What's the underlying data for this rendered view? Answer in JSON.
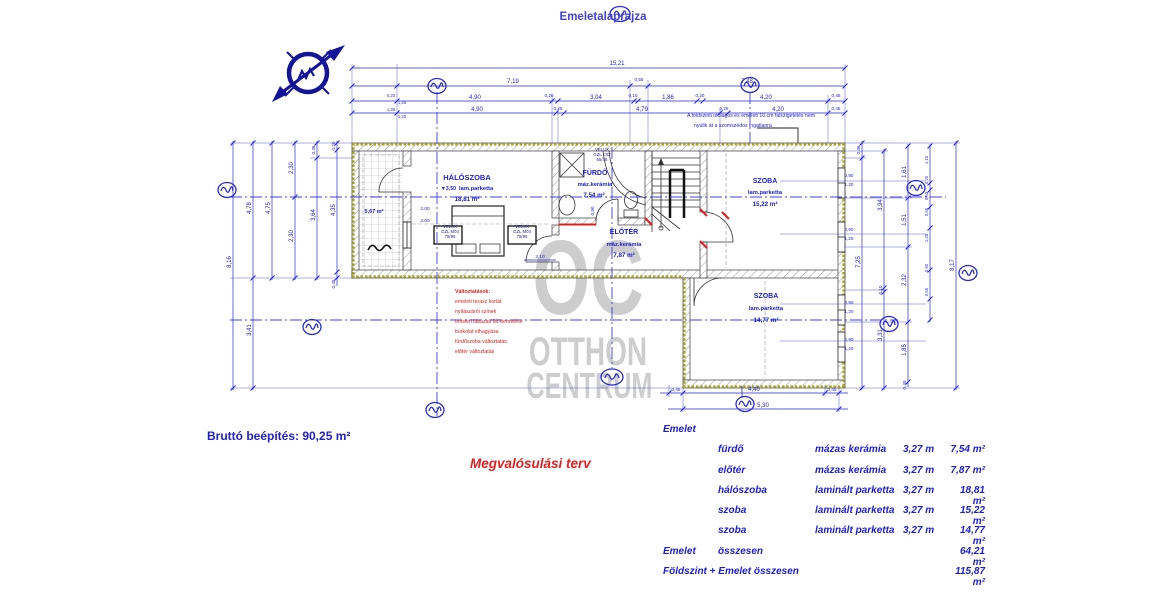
{
  "title": "Emeletalaprajza",
  "watermark": {
    "line1": "OC",
    "line2": "OTTHON",
    "line3": "CENTRUM"
  },
  "plan": {
    "note_line1": "A földszinti utólagos és emeleti 10 cm falszigetelés nem",
    "note_line2": "nyúlik át a szomszédos ingatlanra",
    "rooms": [
      {
        "name": "HÁLÓSZOBA",
        "elev": "▼3,50",
        "finish": "lam.parketta",
        "area": "18,81 m²"
      },
      {
        "name": "FÜRDŐ",
        "finish": "máz.kerámia",
        "area": "7,54 m²"
      },
      {
        "name": "ELŐTÉR",
        "finish": "máz.kerámia",
        "area": "7,87 m²"
      },
      {
        "name": "SZOBA",
        "finish": "lam.parketta",
        "area": "15,22 m²"
      },
      {
        "name": "SZOBA",
        "finish": "lam.parketta",
        "area": "14,77 m²"
      },
      {
        "name": "terasz",
        "area": "5,67 m²"
      }
    ],
    "windows": {
      "velux1": [
        "VELUX",
        "GZL M04",
        "78/98"
      ],
      "velux2": [
        "VELUX",
        "GZL M04",
        "78/98"
      ],
      "velux3": [
        "VELUX",
        "GZL C02",
        "55/78"
      ],
      "tag_w": "0,90",
      "tag_h": "1,20"
    },
    "changes": [
      "Változtatások:",
      "emeleti terasz korlát",
      "nyílászárói színek",
      "emeleti lábazati fal kiemelése",
      "burkolat elhagyása",
      "fürdőszoba változtatás",
      "előtér változtatás"
    ],
    "dims": {
      "overall": "15,21",
      "top2": [
        "7,19",
        "0,55",
        "7,48"
      ],
      "top3": [
        "4,90",
        "0,20",
        "3,04",
        "0,10",
        "1,86",
        "0,20",
        "4,20",
        "0,45"
      ],
      "top4": [
        "4,90",
        "0,25",
        "4,79",
        "0,25",
        "4,20",
        "0,45"
      ],
      "left_stack": [
        "0,20",
        "1,26",
        "1,36",
        "1,20"
      ],
      "left": [
        "8,16",
        "4,78",
        "3,41",
        "4,75",
        "2,30",
        "2,30",
        "0,46",
        "3,64",
        "0,20",
        "4,35",
        "0,45"
      ],
      "right": [
        "0,46",
        "7,25",
        "3,94",
        "0,10",
        "3,31",
        "1,61",
        "1,51",
        "2,32",
        "1,85",
        "0,45",
        "1,15",
        "0,20",
        "0,53",
        "0,65",
        "1,28",
        "0,90",
        "0,65",
        "8,17"
      ],
      "bottom": [
        "0,45",
        "4,40",
        "0,45",
        "5,30"
      ],
      "inner": [
        "2,00",
        "2,00",
        "2,10",
        "0,90"
      ]
    }
  },
  "footer": {
    "gross": "Bruttó beépítés: 90,25 m²",
    "plan_type": "Megvalósulási terv"
  },
  "summary": {
    "header": "Emelet",
    "rows": [
      {
        "room": "fürdő",
        "finish": "mázas kerámia",
        "height": "3,27 m",
        "area": "7,54 m²"
      },
      {
        "room": "előtér",
        "finish": "mázas kerámia",
        "height": "3,27 m",
        "area": "7,87 m²"
      },
      {
        "room": "hálószoba",
        "finish": "laminált parketta",
        "height": "3,27 m",
        "area": "18,81 m²"
      },
      {
        "room": "szoba",
        "finish": "laminált parketta",
        "height": "3,27 m",
        "area": "15,22 m²"
      },
      {
        "room": "szoba",
        "finish": "laminált parketta",
        "height": "3,27 m",
        "area": "14,77 m²"
      }
    ],
    "total_label": "Emelet",
    "total_word": "összesen",
    "total_area": "64,21 m²",
    "grand_label": "Földszint + Emelet összesen",
    "grand_area": "115,87 m²"
  },
  "colors": {
    "ink": "#2a2ad2",
    "red": "#e02020",
    "watermark": "#c9c9c9",
    "wall_accent": "#a8a818",
    "navy": "#14149a"
  }
}
